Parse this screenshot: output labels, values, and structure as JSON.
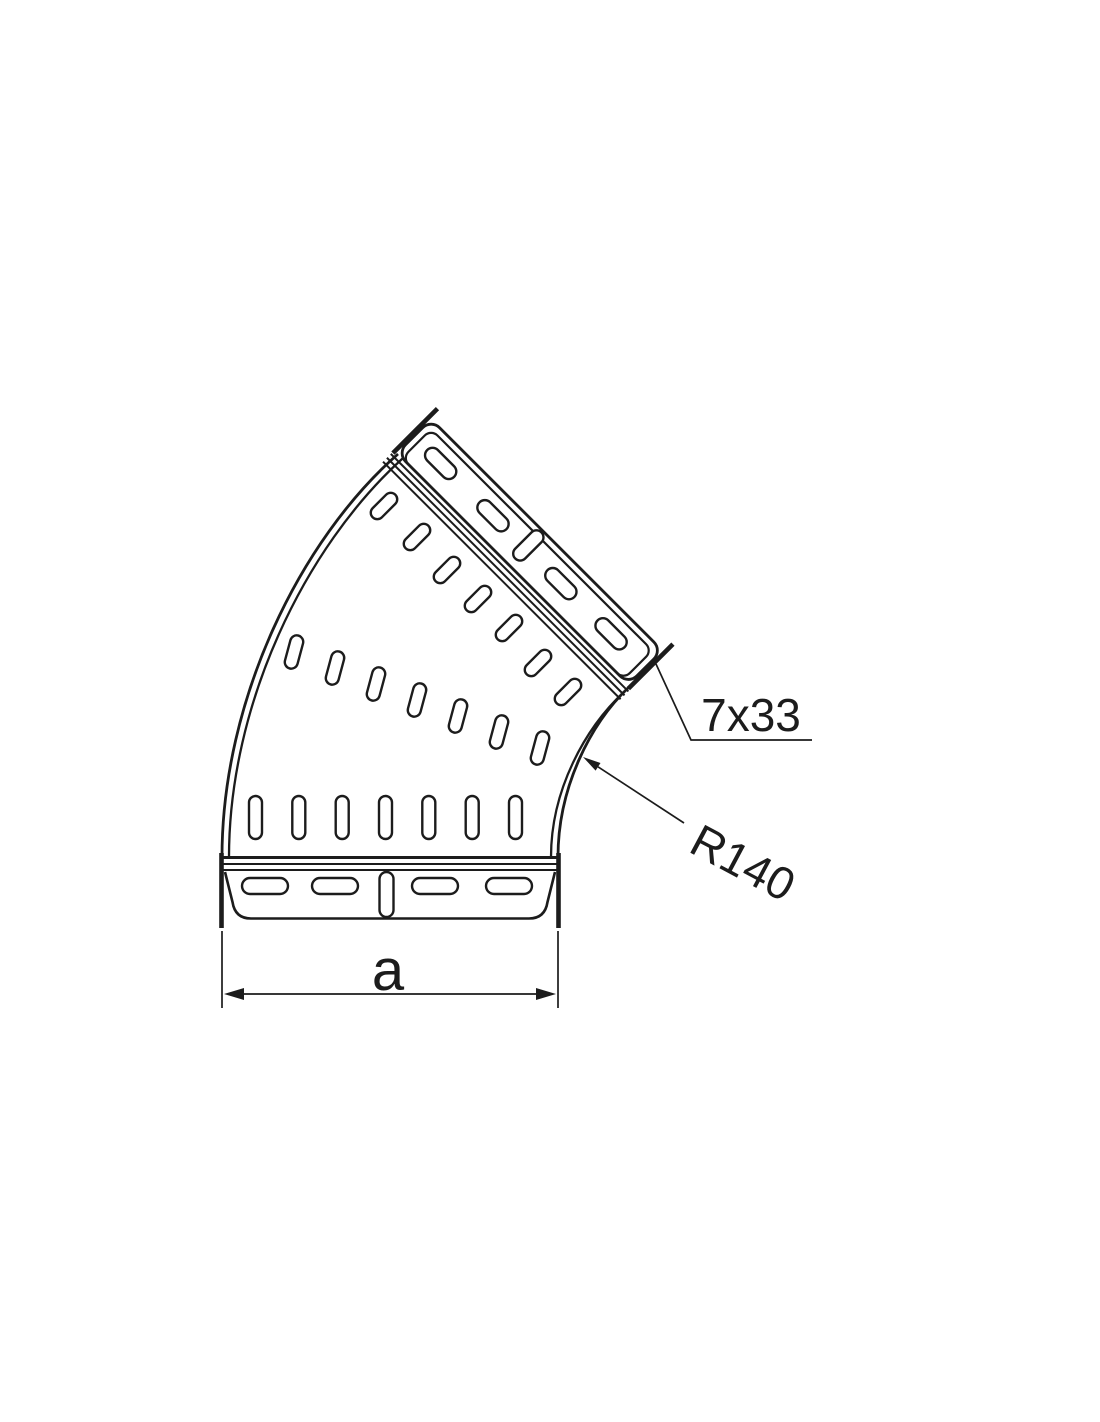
{
  "page": {
    "background": "#ffffff",
    "line_color": "#1c1c1c"
  },
  "drawing": {
    "type": "technical-line-drawing",
    "subject": "45-degree perforated cable tray elbow, plan view",
    "labels": {
      "slot_dimension": "7x33",
      "bend_radius": "R140",
      "width_dimension": "a"
    },
    "perforations": {
      "bottom_vertical_row_slots": 7,
      "middle_tilted_row_slots": 7,
      "upper_diagonal_row_slots": 7,
      "bottom_flange_slots": 5,
      "top_flange_slots": 5
    }
  }
}
